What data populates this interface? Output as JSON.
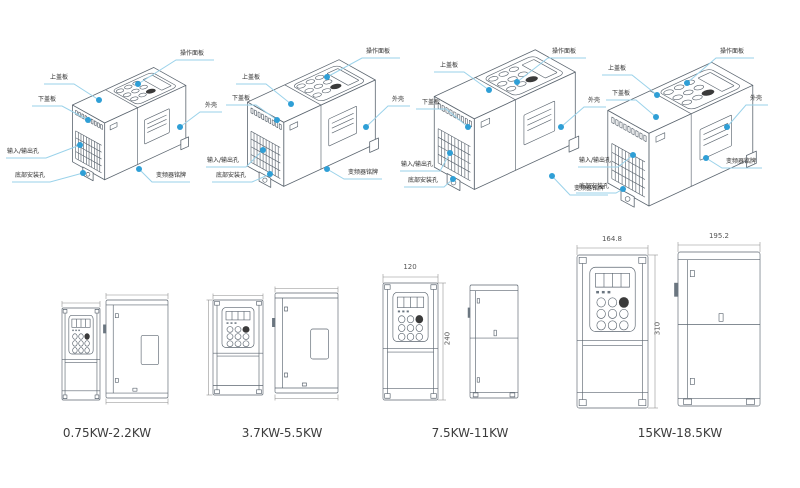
{
  "page": {
    "background": "#ffffff",
    "language": "zh-CN"
  },
  "colors": {
    "page_bg": "#ffffff",
    "callout_dot": "#2f9fd6",
    "leader_line": "#9ad2ea",
    "line_art": "#5c6670",
    "dimension_line": "#8a8a8a",
    "caption_text": "#3c3c3c"
  },
  "callout_labels": {
    "operation_panel": "操作面板",
    "upper_cover": "上盖板",
    "lower_cover": "下盖板",
    "housing": "外壳",
    "io_holes": "输入/输出孔",
    "bottom_mounting_holes": "底部安装孔",
    "inverter_nameplate": "变频器铭牌"
  },
  "bottom_row": {
    "groups": [
      {
        "caption": "0.75KW-2.2KW",
        "dimensions": {}
      },
      {
        "caption": "3.7KW-5.5KW",
        "dimensions": {}
      },
      {
        "caption": "7.5KW-11KW",
        "dimensions": {
          "front_width": "120",
          "height": "240"
        }
      },
      {
        "caption": "15KW-18.5KW",
        "dimensions": {
          "front_width": "164.8",
          "side_depth": "195.2",
          "height": "310"
        }
      }
    ]
  }
}
